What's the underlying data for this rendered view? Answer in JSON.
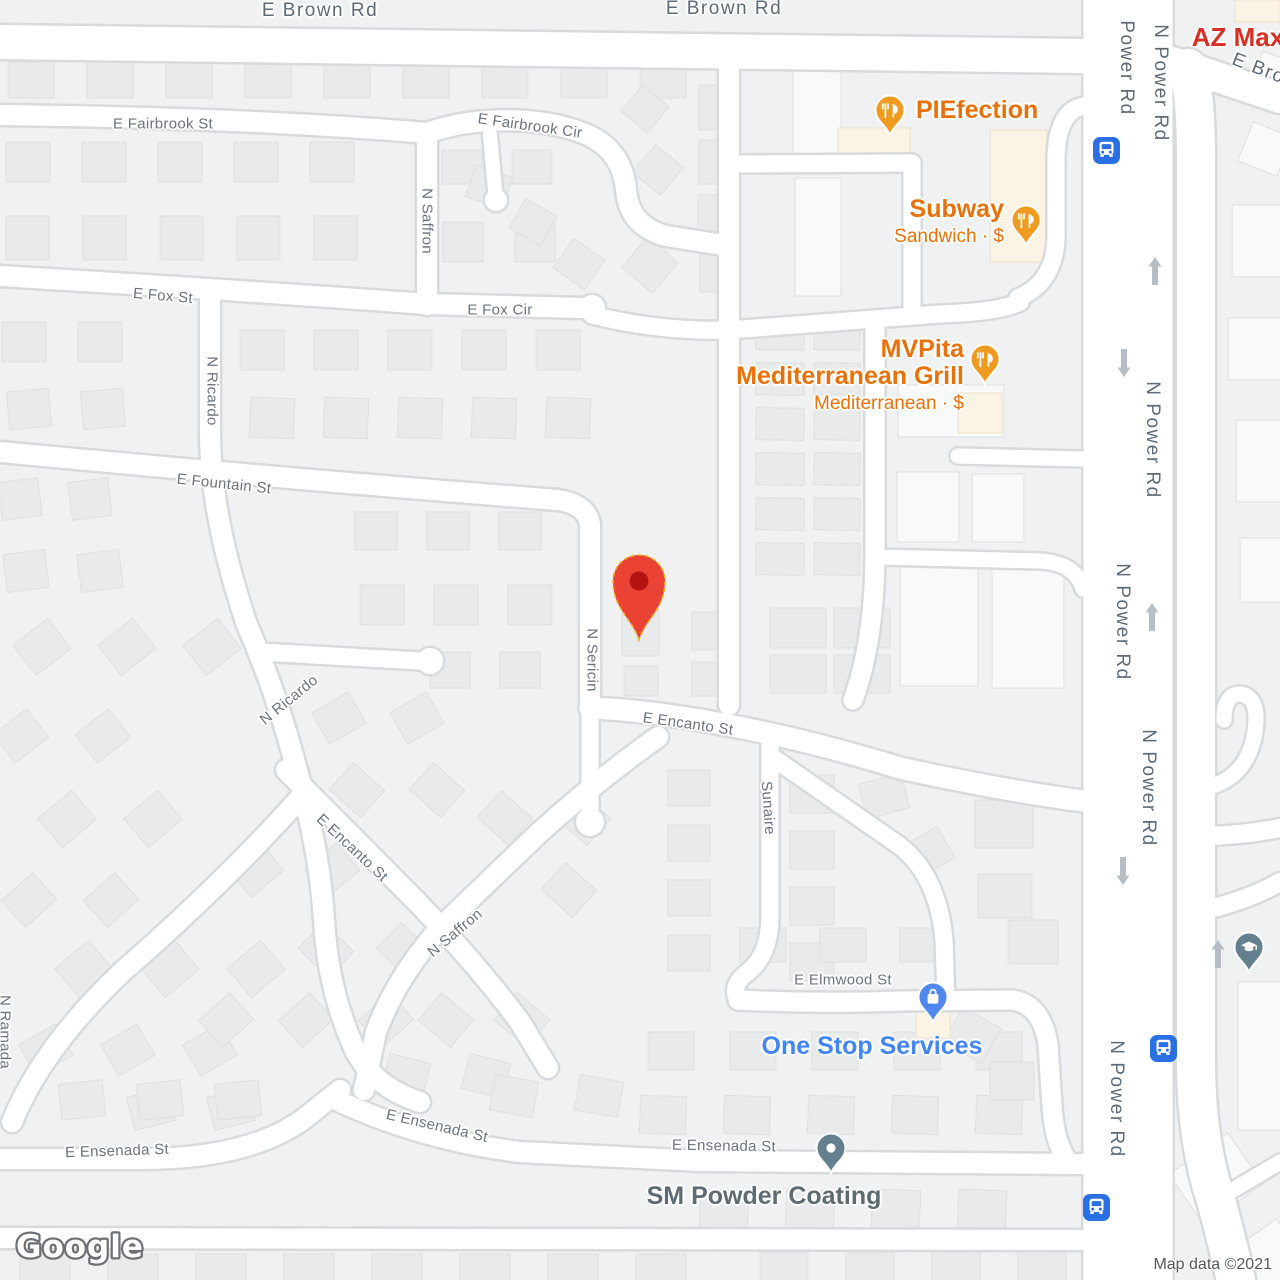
{
  "map": {
    "logo": "Google",
    "attribution": "Map data ©2021",
    "colors": {
      "road_fill": "#ffffff",
      "road_casing": "#d8dade",
      "background": "#f0f1f3",
      "building": "#e9eaec",
      "building_stroke": "#dddfe2",
      "commercial_building": "#f8f9fa",
      "poi_building_peach": "#fbf3e4",
      "street_label": "#6b737d",
      "major_road_label": "#5e6b77",
      "restaurant_orange_text": "#e8710a",
      "restaurant_pin": "#f09a1f",
      "shopping_blue_text": "#4285f4",
      "shopping_pin": "#5088f0",
      "generic_gray_text": "#5d6b73",
      "generic_pin_slate": "#64808e",
      "red_poi_text": "#d93025",
      "destination_red": "#ea4335",
      "destination_red_dark": "#b31412",
      "bus_blue": "#2a6fe3",
      "arrow_gray": "#b7bdc4"
    }
  },
  "street_labels": [
    {
      "text": "E Brown Rd",
      "x": 320,
      "y": 11,
      "rot": 0,
      "kind": "major"
    },
    {
      "text": "E Brown Rd",
      "x": 724,
      "y": 9,
      "rot": 0,
      "kind": "major"
    },
    {
      "text": "E Brown Rd",
      "x": 1287,
      "y": 80,
      "rot": 21,
      "kind": "major"
    },
    {
      "text": "E Fairbrook St",
      "x": 163,
      "y": 124,
      "rot": 0,
      "kind": "minor"
    },
    {
      "text": "E Fairbrook Cir",
      "x": 530,
      "y": 126,
      "rot": 8,
      "kind": "minor"
    },
    {
      "text": "N Saffron",
      "x": 427,
      "y": 221,
      "rot": 90,
      "kind": "minor"
    },
    {
      "text": "E Fox St",
      "x": 163,
      "y": 296,
      "rot": 5,
      "kind": "minor"
    },
    {
      "text": "E Fox Cir",
      "x": 500,
      "y": 310,
      "rot": 0,
      "kind": "minor"
    },
    {
      "text": "N Ricardo",
      "x": 212,
      "y": 391,
      "rot": 90,
      "kind": "minor"
    },
    {
      "text": "E Fountain St",
      "x": 224,
      "y": 484,
      "rot": 6,
      "kind": "minor"
    },
    {
      "text": "N Sericin",
      "x": 592,
      "y": 660,
      "rot": 90,
      "kind": "minor"
    },
    {
      "text": "E Encanto St",
      "x": 688,
      "y": 724,
      "rot": 8,
      "kind": "minor"
    },
    {
      "text": "E Encanto St",
      "x": 352,
      "y": 848,
      "rot": 43,
      "kind": "minor"
    },
    {
      "text": "N Saffron",
      "x": 455,
      "y": 933,
      "rot": -40,
      "kind": "minor"
    },
    {
      "text": "N Ricardo",
      "x": 289,
      "y": 700,
      "rot": -39,
      "kind": "minor"
    },
    {
      "text": "Sunaire",
      "x": 768,
      "y": 808,
      "rot": 86,
      "kind": "minor"
    },
    {
      "text": "E Elmwood St",
      "x": 843,
      "y": 980,
      "rot": 0,
      "kind": "minor"
    },
    {
      "text": "E Ensenada St",
      "x": 117,
      "y": 1151,
      "rot": -2,
      "kind": "minor"
    },
    {
      "text": "E Ensenada St",
      "x": 437,
      "y": 1126,
      "rot": 13,
      "kind": "minor"
    },
    {
      "text": "E Ensenada St",
      "x": 724,
      "y": 1146,
      "rot": 1,
      "kind": "minor"
    },
    {
      "text": "N Ramada",
      "x": 5,
      "y": 1032,
      "rot": 90,
      "kind": "minor"
    },
    {
      "text": "Power Rd",
      "x": 1126,
      "y": 68,
      "rot": 90,
      "kind": "major"
    },
    {
      "text": "N Power Rd",
      "x": 1160,
      "y": 83,
      "rot": 90,
      "kind": "major"
    },
    {
      "text": "N Power Rd",
      "x": 1152,
      "y": 440,
      "rot": 90,
      "kind": "major"
    },
    {
      "text": "N Power Rd",
      "x": 1122,
      "y": 622,
      "rot": 90,
      "kind": "major"
    },
    {
      "text": "N Power Rd",
      "x": 1148,
      "y": 788,
      "rot": 90,
      "kind": "major"
    },
    {
      "text": "N Power Rd",
      "x": 1116,
      "y": 1099,
      "rot": 90,
      "kind": "major"
    }
  ],
  "pois": [
    {
      "name": "PIEfection",
      "subtitle": "",
      "type": "restaurant",
      "pin": {
        "x": 890,
        "y": 135
      },
      "label": {
        "x": 916,
        "y": 111,
        "anchor": "start"
      }
    },
    {
      "name": "Subway",
      "subtitle": "Sandwich · $",
      "type": "restaurant",
      "pin": {
        "x": 1026,
        "y": 245
      },
      "label": {
        "x": 1004,
        "y": 210,
        "anchor": "end"
      }
    },
    {
      "name": "MVPita\nMediterranean Grill",
      "subtitle": "Mediterranean · $",
      "type": "restaurant",
      "pin": {
        "x": 985,
        "y": 384
      },
      "label": {
        "x": 964,
        "y": 350,
        "anchor": "end"
      }
    },
    {
      "name": "One Stop Services",
      "subtitle": "",
      "type": "shopping",
      "pin": {
        "x": 933,
        "y": 1022
      },
      "label": {
        "x": 872,
        "y": 1047,
        "anchor": "middle"
      }
    },
    {
      "name": "SM Powder Coating",
      "subtitle": "",
      "type": "generic",
      "pin": {
        "x": 831,
        "y": 1173
      },
      "label": {
        "x": 764,
        "y": 1197,
        "anchor": "middle"
      }
    },
    {
      "name": "",
      "subtitle": "",
      "type": "school",
      "pin": {
        "x": 1249,
        "y": 972
      },
      "label": null
    },
    {
      "name": "AZ Max",
      "subtitle": "",
      "type": "red_label_only",
      "pin": null,
      "label": {
        "x": 1238,
        "y": 38,
        "anchor": "middle"
      }
    }
  ],
  "destination_marker": {
    "x": 639,
    "y": 640
  },
  "transit_stops": [
    {
      "x": 1106,
      "y": 150
    },
    {
      "x": 1163,
      "y": 1048
    },
    {
      "x": 1096,
      "y": 1207
    }
  ],
  "one_way_arrows": [
    {
      "x": 1155,
      "y": 271,
      "dir": "up"
    },
    {
      "x": 1124,
      "y": 363,
      "dir": "down"
    },
    {
      "x": 1152,
      "y": 617,
      "dir": "up"
    },
    {
      "x": 1123,
      "y": 871,
      "dir": "down"
    },
    {
      "x": 1218,
      "y": 954,
      "dir": "up"
    }
  ]
}
